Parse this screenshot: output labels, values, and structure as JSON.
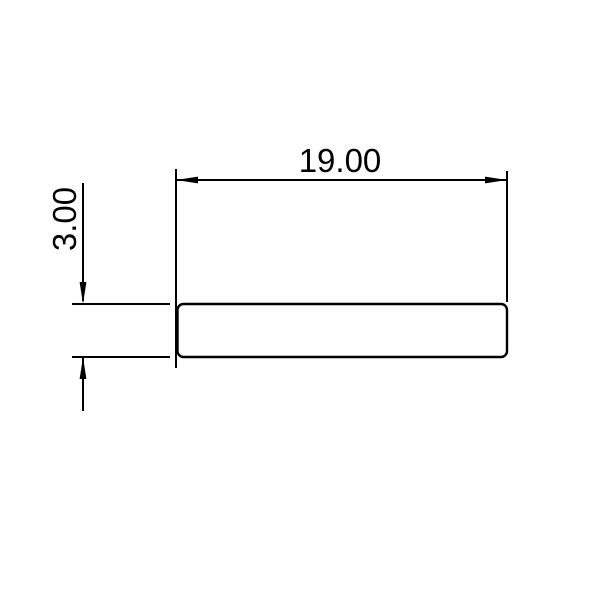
{
  "drawing": {
    "width_dimension": {
      "label": "19.00",
      "value": 19.0
    },
    "thickness_dimension": {
      "label": "3.00",
      "value": 3.0
    },
    "colors": {
      "line_color": "#000000",
      "background_color": "#ffffff"
    }
  }
}
